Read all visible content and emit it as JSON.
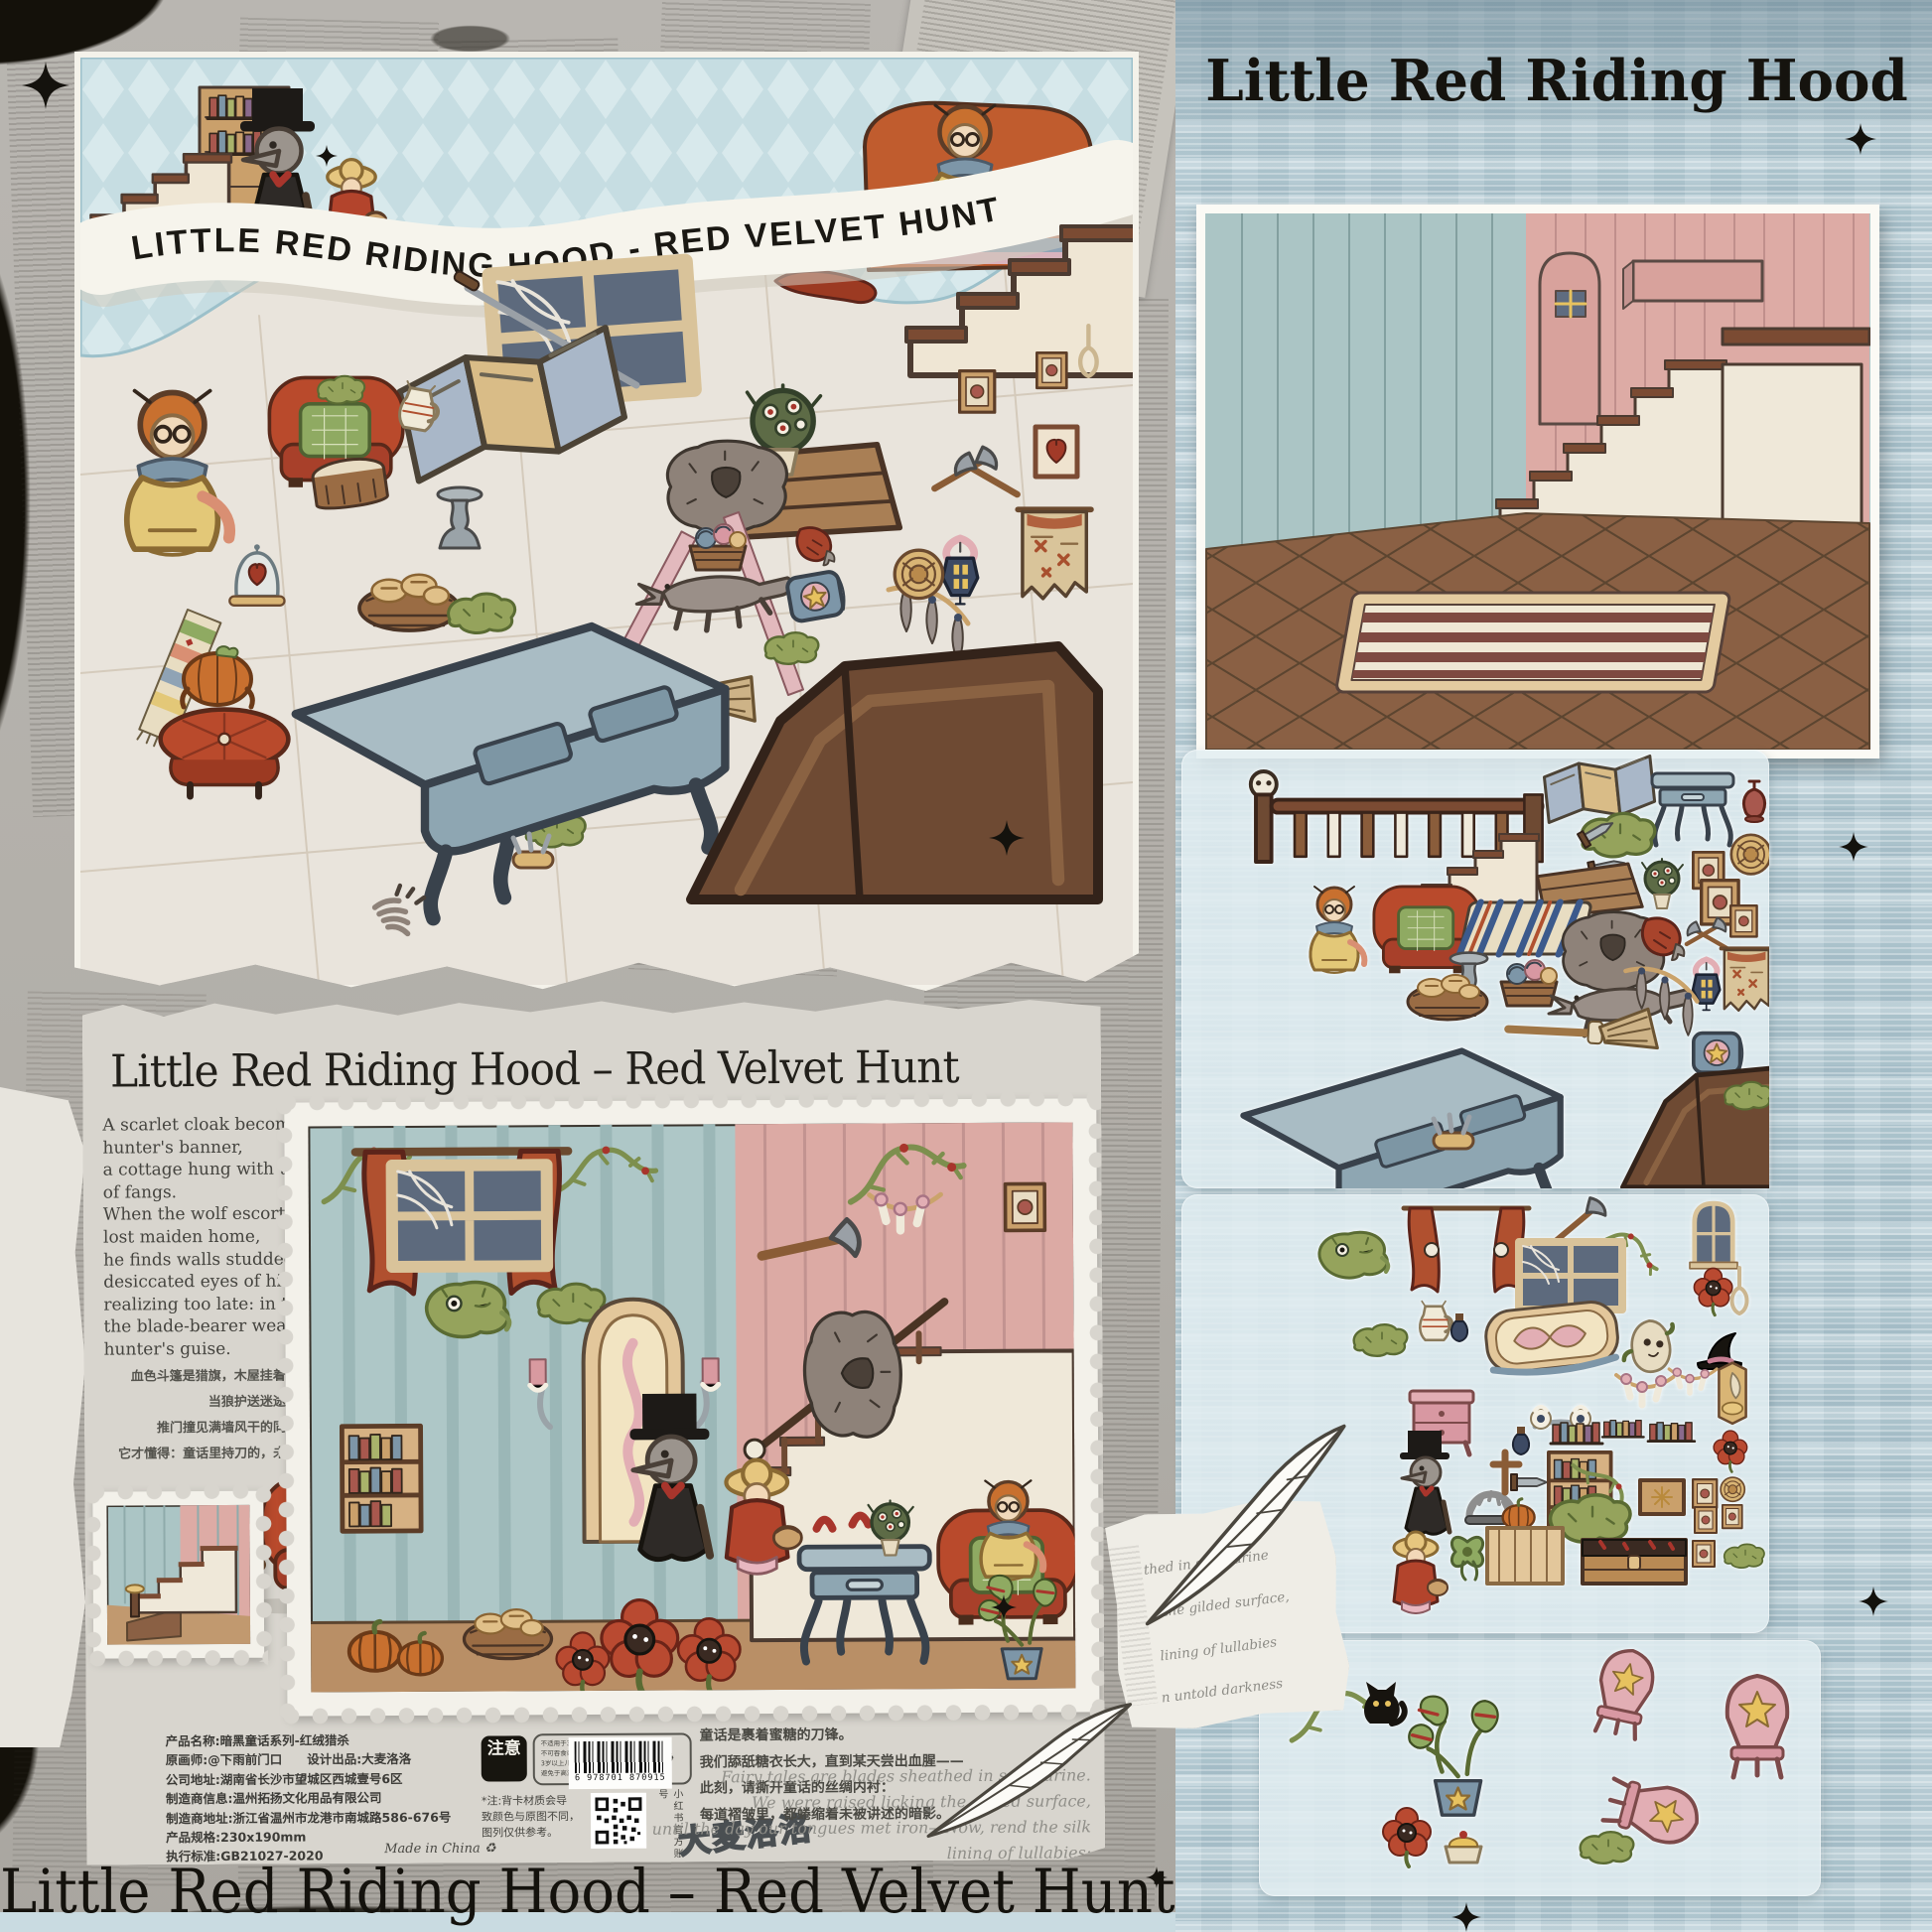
{
  "page": {
    "footer_title": "Little Red Riding Hood – Red Velvet Hunt"
  },
  "front_box": {
    "banner_title": "LITTLE RED RIDING HOOD - RED VELVET HUNT"
  },
  "right_panel": {
    "title": "Little Red Riding Hood",
    "script_fragments": {
      "f1": "thed in saccharine",
      "f2": "the gilded surface,",
      "f3": "lining of lullabies",
      "f4": "n untold darkness"
    }
  },
  "back_panel": {
    "title": "Little Red Riding Hood – Red Velvet Hunt",
    "poem_en": "A scarlet cloak becomes a\nhunter's banner,\na cottage hung with trophies\nof fangs.\nWhen the wolf escorts the\nlost maiden home,\nhe finds walls studded with\ndesiccated eyes of his kin—\nrealizing too late: in this tale,\nthe blade-bearer wears no\nhunter's guise.",
    "poem_zh": "血色斗篷是猎旗，木屋挂着兽首勋章。\n当狼护送迷途少女归家，\n推门撞见满墙风干的同类眼瞳——\n它才懂得：童话里持刀的，未必是猎人。",
    "quote_zh": "童话是裹着蜜糖的刀锋。\n我们舔舐糖衣长大，直到某天尝出血腥——\n此刻，请撕开童话的丝绸内衬：\n每道褶皱里，都蜷缩着未被讲述的暗影。",
    "quote_en": "Fairy tales are blades sheathed in saccharine.\nWe were raised licking the gilded surface,\nuntil the day our tongues met iron—Now, rend the silk lining of lullabies:\nin every crease, lurks an untold darkness.",
    "product_info": "产品名称:暗黑童话系列-红绒猎杀\n原画师:@下雨前门口　　设计出品:大麦洛洛\n公司地址:湖南省长沙市望城区西城壹号6区\n制造商信息:温州拓扬文化用品有限公司\n制造商地址:浙江省温州市龙港市南城路586-676号\n产品规格:230x190mm\n执行标准:GB21027-2020",
    "made_in": "Made in China",
    "notice_label": "注意",
    "notice_text": "不适用于3岁以下幼儿。\n不可吞食或塞于口鼻处以免窒息。\n3岁以上儿童需在成人陪同下使用。\n避免于高温、潮湿环境下存放本产品。",
    "note_text": "*注:背卡材质会导\n致颜色与原图不同，\n图列仅供参考。",
    "qr_caption": "小红书官方账号",
    "barcode_digits": "6 978701 870915",
    "brand_logo": "大麦洛洛"
  },
  "stickers": {
    "sheet1_items": [
      "skull-banister",
      "folding-screen",
      "side-table",
      "vase",
      "staircase",
      "moss-with-swords",
      "crate-lid",
      "eyeball-plant",
      "woven-plate",
      "picture-frames",
      "red-armchair",
      "granny",
      "striped-rug",
      "wolf-pelt",
      "torn-red-cloak",
      "crossed-axes",
      "wall-lantern",
      "map-tapestry",
      "candlestick",
      "bread-basket",
      "yarn-basket",
      "sleeping-wolf",
      "witch-broom",
      "tassel-garland",
      "spell-book",
      "blue-console-table",
      "wooden-pew",
      "knife-bundle",
      "moss-clump"
    ],
    "sheet2_items": [
      "red-curtains",
      "battle-axe",
      "thorn-vine",
      "arched-window",
      "cobweb-window",
      "poppy-bloom",
      "noose",
      "moss-critter",
      "jug-and-jars",
      "stained-glass-door",
      "skull-sack",
      "witch-hat",
      "bone-garland",
      "horn-trophy",
      "pink-nightstand",
      "eye-candle",
      "book-rows",
      "red-flower",
      "wolf-gentleman",
      "bear-trap",
      "wooden-cross",
      "dagger",
      "potion-bottle",
      "bookshelf",
      "vine-corner",
      "framed-sun",
      "small-frames",
      "pumpkin",
      "red-riding-hood-girl",
      "vine-bow",
      "wood-panel",
      "bloody-chest",
      "moss-clumps"
    ],
    "sheet3_items": [
      "moss-branch",
      "black-cat",
      "venus-flytrap-pot",
      "star-shield-chair",
      "star-back-chair",
      "tipped-star-chair",
      "poppy-and-custard"
    ]
  },
  "colors": {
    "fabric_blue": "#b7cdd6",
    "box_blue": "#c6dde2",
    "paper_gray": "#d8d5ce",
    "stamp_cream": "#f3f1ea",
    "wall_blue": "#abc5c5",
    "wall_pink": "#ddaba5",
    "floor_tan": "#c1996f",
    "floor_brown": "#8a6044",
    "accent_red": "#b0502f",
    "table_blue": "#93abb8",
    "ink": "#17150f"
  }
}
